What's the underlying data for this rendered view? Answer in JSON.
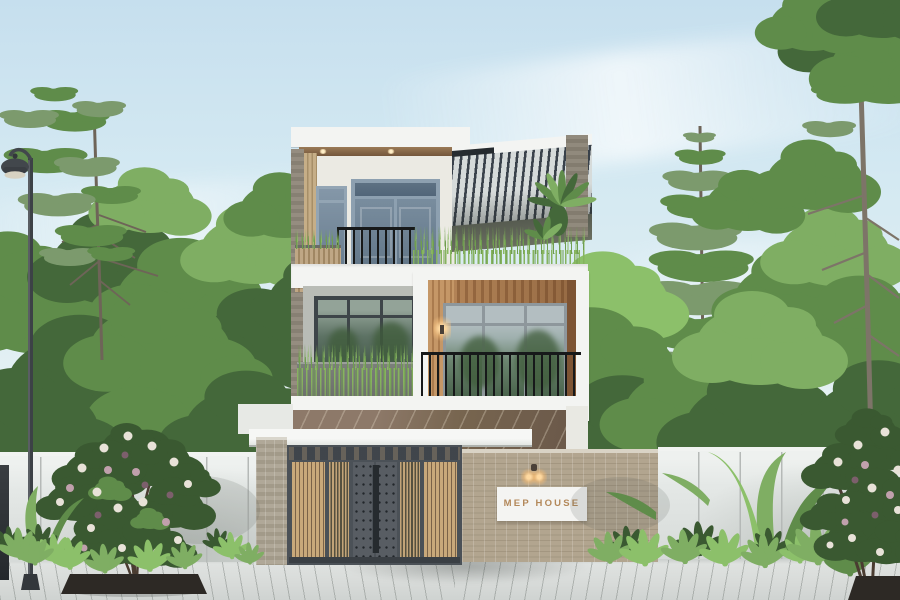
{
  "scene": {
    "house_sign": {
      "text": "MEP HOUSE"
    }
  },
  "colors": {
    "sky-top": "#c6dfee",
    "sky-mid": "#dfeef3",
    "sky-low": "#edf5f4",
    "fol-dark": "#44683a",
    "fol-mid": "#5f8c4a",
    "fol-light": "#7fae63",
    "fol-gray": "#7c9a6d",
    "fol-bright": "#8cc06a",
    "trunk": "#6e6458",
    "roof-white": "#f3f4f2",
    "soffit-a": "#9a7a56",
    "soffit-b": "#6f5238",
    "wall-white": "#ebeae3",
    "wall-gray": "#b9bcb6",
    "door-blue": "#7e92a3",
    "door-blue-dark": "#64788a",
    "door-frame": "#8da0b0",
    "frame-dark": "#3e4549",
    "alum": "#8e979c",
    "glass-light": "#b3bec1",
    "wood-slat": "#c6ae87",
    "wood-slat-dark": "#a78f68",
    "balcony-wood-a": "#b8885a",
    "balcony-wood-b": "#9c6d44",
    "jamb-wood": "#c59767",
    "railing": "#17191a",
    "louver": "#39414a",
    "louver-bg": "#d6dbda",
    "grass": "#6f9e4f",
    "grass-light": "#8cba63",
    "vine": "#86b35e",
    "marble-a": "#8d7969",
    "marble-b": "#6b594a",
    "fence-white": "#e4e8e6",
    "fence-cap": "#f1f3f1",
    "fence-joint": "#b5b9b7",
    "brick-fence": "#b2a58f",
    "brick-line": "#a39680",
    "post-brick": "#b0a898",
    "gate-frame": "#4b5157",
    "gate-panel": "#585d63",
    "gate-dark": "#262b2f",
    "gate-wood": "#c8a87a",
    "sign-bg": "#f4f4f2",
    "sign-gold": "#b3885a",
    "gold-glow": "#ffd9a0",
    "lamp-metal": "#42474c",
    "pave": "#d8dbd9",
    "soil": "#2d2925",
    "flower-white": "#e8e2d8",
    "flower-pink": "#c0a0ac",
    "flower-dark": "#7c5f6c"
  }
}
